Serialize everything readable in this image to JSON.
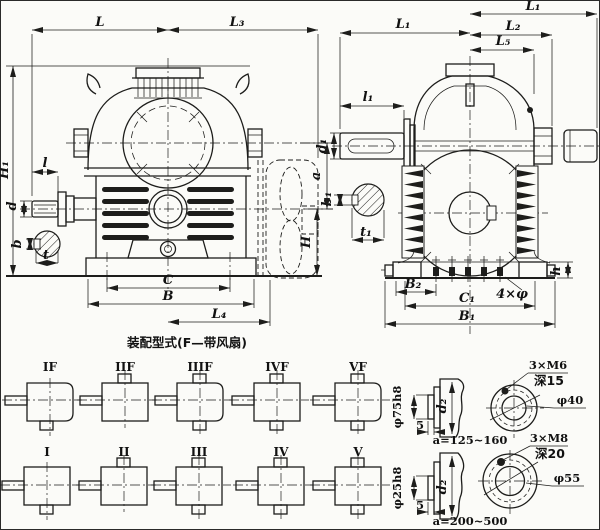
{
  "colors": {
    "line": "#1d1d1b",
    "paper": "#fbfbf8"
  },
  "front_view": {
    "dims": {
      "L": "L",
      "L3": "L₃",
      "H1": "H₁",
      "l": "l",
      "d": "d",
      "b": "b",
      "t": "t",
      "C": "C",
      "B": "B",
      "L4": "L₄"
    }
  },
  "side_view": {
    "dims": {
      "L1_top": "L₁",
      "L1": "L₁",
      "L2": "L₂",
      "L5": "L₅",
      "l1": "l₁",
      "d1": "d₁",
      "b1": "b₁",
      "t1": "t₁",
      "a": "a",
      "H": "H",
      "B2": "B₂",
      "C1": "C₁",
      "B1": "B₁",
      "h": "h",
      "holes": "4×φ"
    }
  },
  "caption": "装配型式(F—带风扇)",
  "types": {
    "f_row": [
      "IF",
      "IIF",
      "IIIF",
      "IVF",
      "VF"
    ],
    "plain_row": [
      "I",
      "II",
      "III",
      "IV",
      "V"
    ]
  },
  "detail_small": {
    "spigot_dia": "φ75h8",
    "spigot_len": "5",
    "shaft_dia": "d₂",
    "center_distance": "a=125~160",
    "tapped_holes": "3×M6",
    "hole_depth": "深15",
    "bore_dia": "φ40"
  },
  "detail_large": {
    "spigot_dia": "φ25h8",
    "spigot_len": "5",
    "shaft_dia": "d₂",
    "center_distance": "a=200~500",
    "tapped_holes": "3×M8",
    "hole_depth": "深20",
    "bore_dia": "φ55"
  }
}
